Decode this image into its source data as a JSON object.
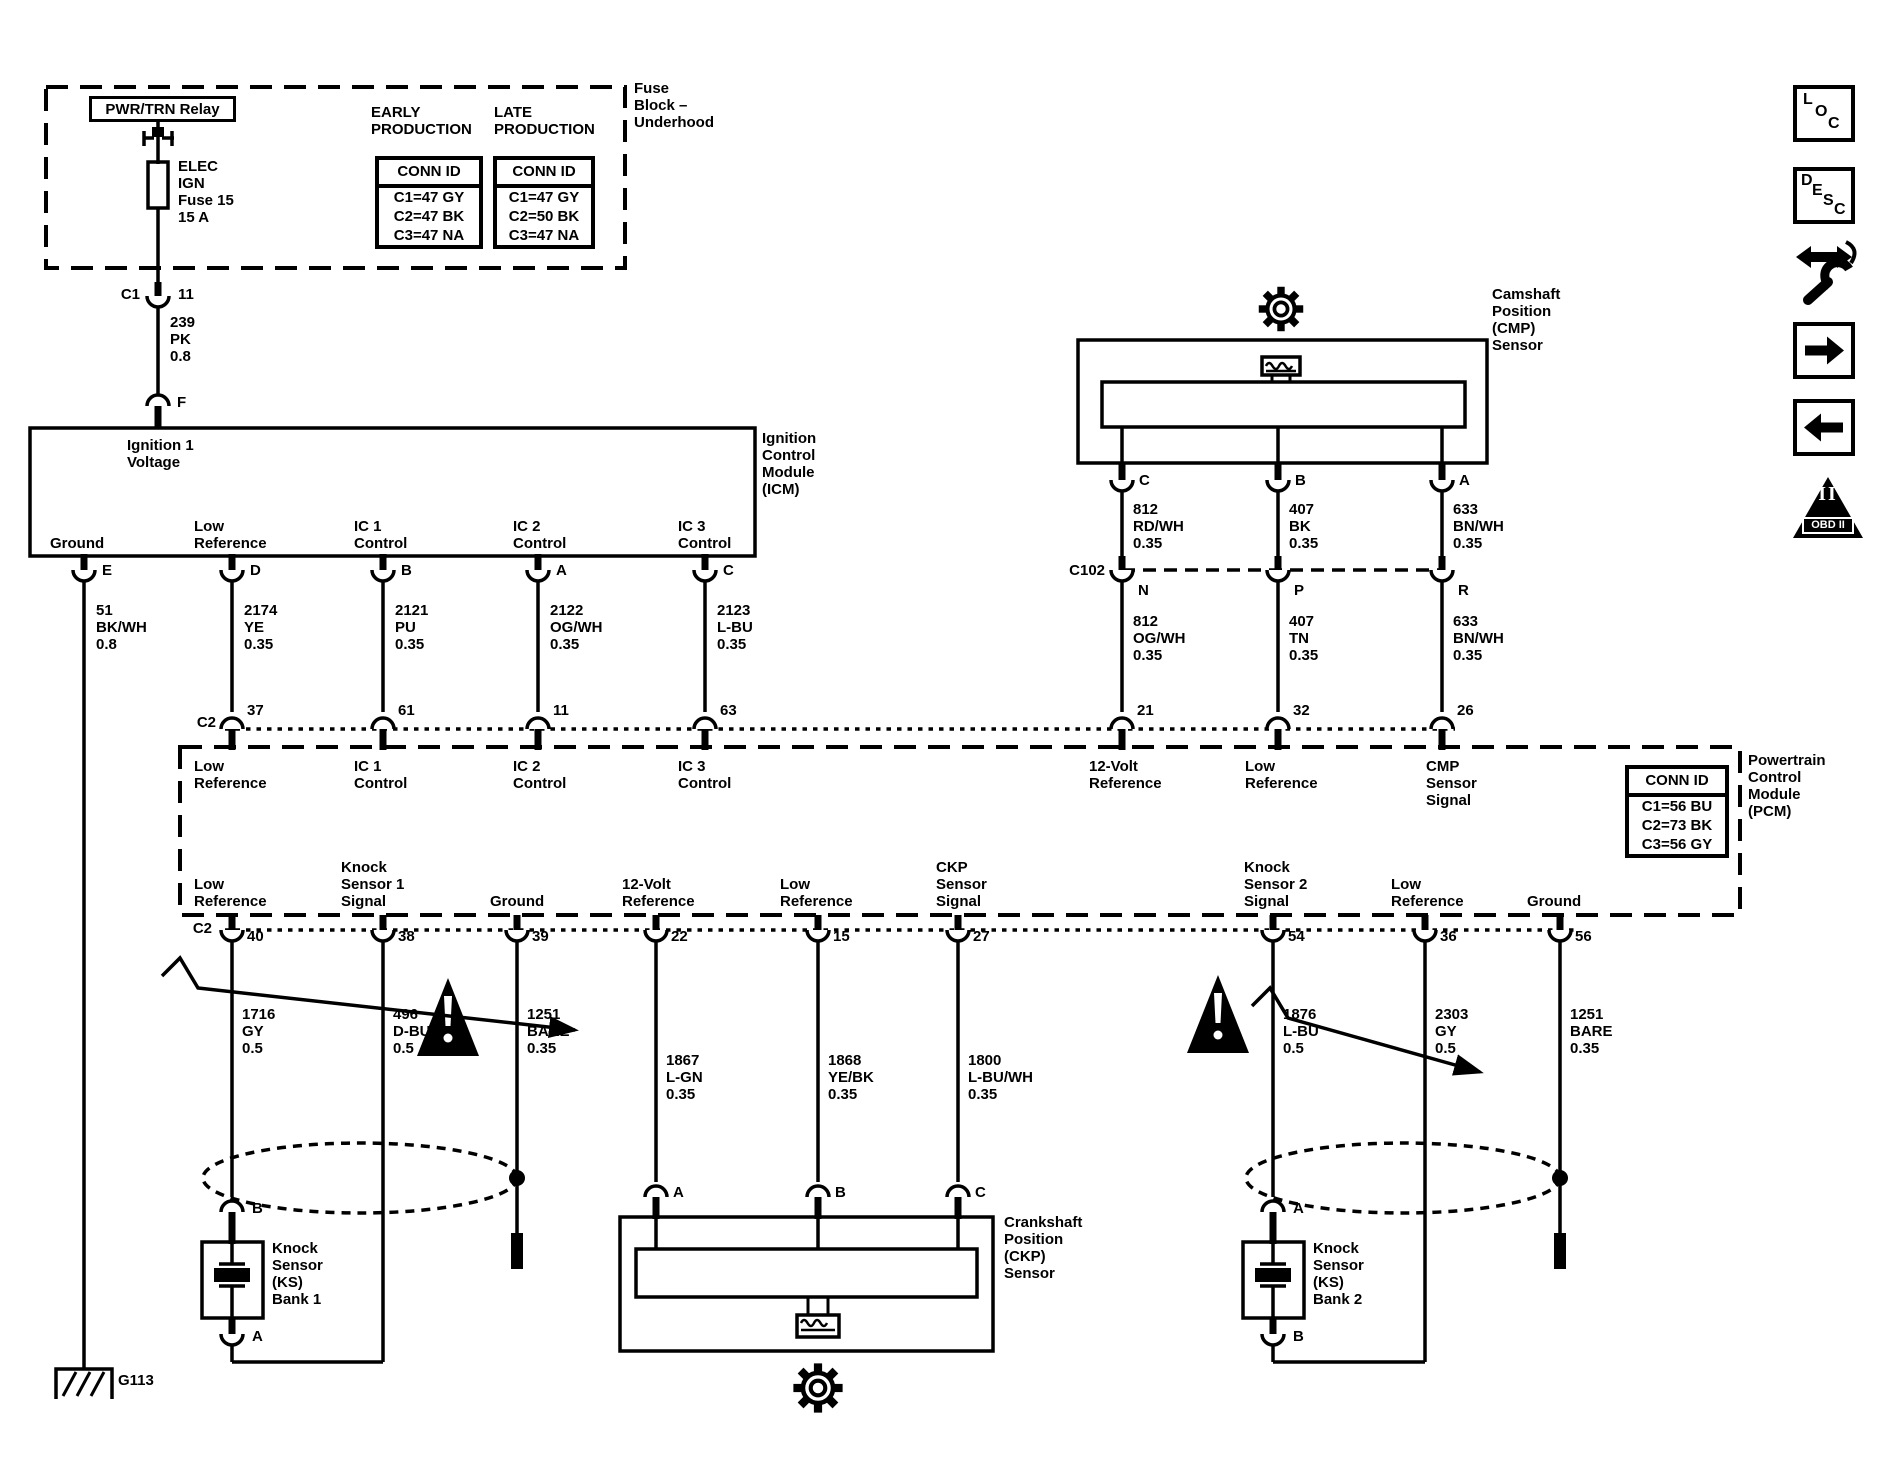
{
  "colors": {
    "ink": "#000000",
    "paper": "#ffffff"
  },
  "fuse_block": {
    "relay_label": "PWR/TRN Relay",
    "fuse_label": "ELEC\nIGN\nFuse 15\n15 A",
    "outside_label": "Fuse\nBlock –\nUnderhood",
    "early_heading": "EARLY\nPRODUCTION",
    "late_heading": "LATE\nPRODUCTION",
    "early_table": {
      "header": "CONN ID",
      "rows": [
        "C1=47 GY",
        "C2=47 BK",
        "C3=47 NA"
      ]
    },
    "late_table": {
      "header": "CONN ID",
      "rows": [
        "C1=47 GY",
        "C2=50 BK",
        "C3=47 NA"
      ]
    },
    "connector_label": "C1",
    "connector_pin": "11",
    "wire_label": "239\nPK\n0.8",
    "module_pin": "F"
  },
  "icm": {
    "input_label": "Ignition 1\nVoltage",
    "outside_label": "Ignition\nControl\nModule\n(ICM)",
    "pins": [
      {
        "letter": "E",
        "function": "Ground",
        "wire": "51\nBK/WH\n0.8",
        "x": 84,
        "lx": 50
      },
      {
        "letter": "D",
        "function": "Low\nReference",
        "wire": "2174\nYE\n0.35",
        "x": 232,
        "lx": 194
      },
      {
        "letter": "B",
        "function": "IC 1\nControl",
        "wire": "2121\nPU\n0.35",
        "x": 383,
        "lx": 354
      },
      {
        "letter": "A",
        "function": "IC 2\nControl",
        "wire": "2122\nOG/WH\n0.35",
        "x": 538,
        "lx": 513
      },
      {
        "letter": "C",
        "function": "IC 3\nControl",
        "wire": "2123\nL-BU\n0.35",
        "x": 705,
        "lx": 678
      }
    ]
  },
  "cmp": {
    "label": "Camshaft\nPosition\n(CMP)\nSensor",
    "connector_label": "C102",
    "pins": [
      {
        "letter": "C",
        "wire_upper": "812\nRD/WH\n0.35",
        "c102_letter": "N",
        "wire_lower": "812\nOG/WH\n0.35",
        "x": 1122
      },
      {
        "letter": "B",
        "wire_upper": "407\nBK\n0.35",
        "c102_letter": "P",
        "wire_lower": "407\nTN\n0.35",
        "x": 1278
      },
      {
        "letter": "A",
        "wire_upper": "633\nBN/WH\n0.35",
        "c102_letter": "R",
        "wire_lower": "633\nBN/WH\n0.35",
        "x": 1442
      }
    ]
  },
  "pcm": {
    "outside_label": "Powertrain\nControl\nModule\n(PCM)",
    "conn_table": {
      "header": "CONN ID",
      "rows": [
        "C1=56 BU",
        "C2=73 BK",
        "C3=56 GY"
      ]
    },
    "top_connector": "C2",
    "top_pins": [
      {
        "num": "37",
        "function": "Low\nReference",
        "x": 232,
        "lx": 194
      },
      {
        "num": "61",
        "function": "IC 1\nControl",
        "x": 383,
        "lx": 354
      },
      {
        "num": "11",
        "function": "IC 2\nControl",
        "x": 538,
        "lx": 513
      },
      {
        "num": "63",
        "function": "IC 3\nControl",
        "x": 705,
        "lx": 678
      },
      {
        "num": "21",
        "function": "12-Volt\nReference",
        "x": 1122,
        "lx": 1089
      },
      {
        "num": "32",
        "function": "Low\nReference",
        "x": 1278,
        "lx": 1245
      },
      {
        "num": "26",
        "function": "CMP\nSensor\nSignal",
        "x": 1442,
        "lx": 1426
      }
    ],
    "bottom_connector": "C2",
    "bottom_pins": [
      {
        "num": "40",
        "function": "Low\nReference",
        "wire": "1716\nGY\n0.5",
        "x": 232,
        "lx": 194,
        "ly": 1006
      },
      {
        "num": "38",
        "function": "Knock\nSensor 1\nSignal",
        "wire": "496\nD-BU\n0.5",
        "x": 383,
        "lx": 341,
        "ly": 1006
      },
      {
        "num": "39",
        "function": "Ground",
        "wire": "1251\nBARE\n0.35",
        "x": 517,
        "lx": 490,
        "ly": 1006
      },
      {
        "num": "22",
        "function": "12-Volt\nReference",
        "wire": "1867\nL-GN\n0.35",
        "x": 656,
        "lx": 622,
        "ly": 1052
      },
      {
        "num": "15",
        "function": "Low\nReference",
        "wire": "1868\nYE/BK\n0.35",
        "x": 818,
        "lx": 780,
        "ly": 1052
      },
      {
        "num": "27",
        "function": "CKP\nSensor\nSignal",
        "wire": "1800\nL-BU/WH\n0.35",
        "x": 958,
        "lx": 936,
        "ly": 1052
      },
      {
        "num": "54",
        "function": "Knock\nSensor 2\nSignal",
        "wire": "1876\nL-BU\n0.5",
        "x": 1273,
        "lx": 1244,
        "ly": 1006
      },
      {
        "num": "36",
        "function": "Low\nReference",
        "wire": "2303\nGY\n0.5",
        "x": 1425,
        "lx": 1391,
        "ly": 1006
      },
      {
        "num": "56",
        "function": "Ground",
        "wire": "1251\nBARE\n0.35",
        "x": 1560,
        "lx": 1527,
        "ly": 1006
      }
    ]
  },
  "ckp": {
    "label": "Crankshaft\nPosition\n(CKP)\nSensor",
    "pins": [
      {
        "letter": "A",
        "x": 656
      },
      {
        "letter": "B",
        "x": 818
      },
      {
        "letter": "C",
        "x": 958
      }
    ]
  },
  "ks1": {
    "label": "Knock\nSensor\n(KS)\nBank 1",
    "top_pin": "B",
    "bottom_pin": "A"
  },
  "ks2": {
    "label": "Knock\nSensor\n(KS)\nBank 2",
    "top_pin": "A",
    "bottom_pin": "B"
  },
  "ground": {
    "label": "G113"
  },
  "sidebar": {
    "loc_letters": [
      "L",
      "O",
      "C"
    ],
    "desc_letters": [
      "D",
      "E",
      "S",
      "C"
    ],
    "obd_numeral": "II",
    "obd_label": "OBD II",
    "icons": [
      "loc",
      "desc",
      "wrench-swap",
      "forward-arrow",
      "back-arrow",
      "obd-ii-triangle"
    ]
  }
}
